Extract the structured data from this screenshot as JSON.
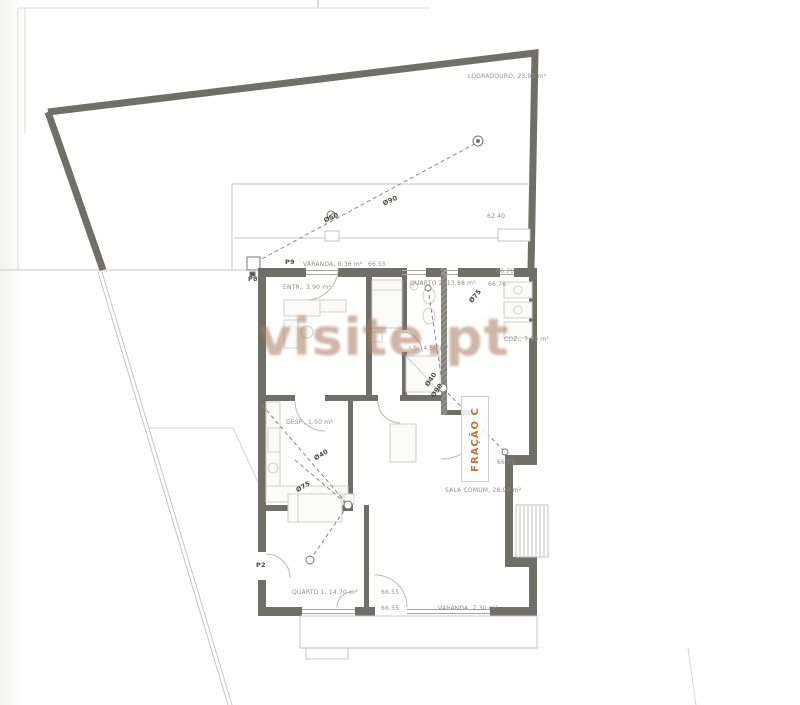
{
  "page": {
    "type": "scanned architectural floor plan"
  },
  "watermark": {
    "text": "visite.pt",
    "color": "#a87a5d"
  },
  "colors": {
    "wall": "#6f6e68",
    "boundary": "#6f6e68",
    "thin_line": "#c6c6c4",
    "furniture": "#cfcfcd",
    "pipe": "#8a8a8a",
    "label": "#8f8f8b",
    "accent_orange": "#c0763a",
    "balcony_edge": "#cbb9a4"
  },
  "plan": {
    "fraction": "FRAÇÃO C",
    "site": {
      "logradouro": "LOGRADOURO, 23.90 m²"
    },
    "labels": {
      "varanda_top": "VARANDA, 6.36 m²",
      "entrada": "ENTR., 3.90 m²",
      "quarto2": "QUARTO 2, 13.88 m²",
      "is1": "I.S., 4.50 m²",
      "coz": "COZ., 7.00 m²",
      "desp": "DESP., 1.50 m²",
      "sala": "SALA COMUM, 28.94 m²",
      "quarto1": "QUARTO 1, 14.70 m²",
      "varanda_bottom": "VARANDA, 7.30 m²"
    },
    "levels": {
      "terrace": "62.40",
      "top": "66.55",
      "q2a": "66.76",
      "q2b": "66.76",
      "sala": "66.75",
      "bottom1": "66.55",
      "bottom2": "66.55"
    },
    "pipe_labels": {
      "upper_main": "Ø90",
      "upper_mid": "Ø50",
      "kitchen_a": "Ø40",
      "kitchen_b": "Ø75",
      "wc_a": "Ø40",
      "wc_b": "Ø90",
      "wc_c": "Ø75"
    },
    "point_labels": {
      "p2": "P2",
      "p8": "P8",
      "p9": "P9"
    }
  }
}
